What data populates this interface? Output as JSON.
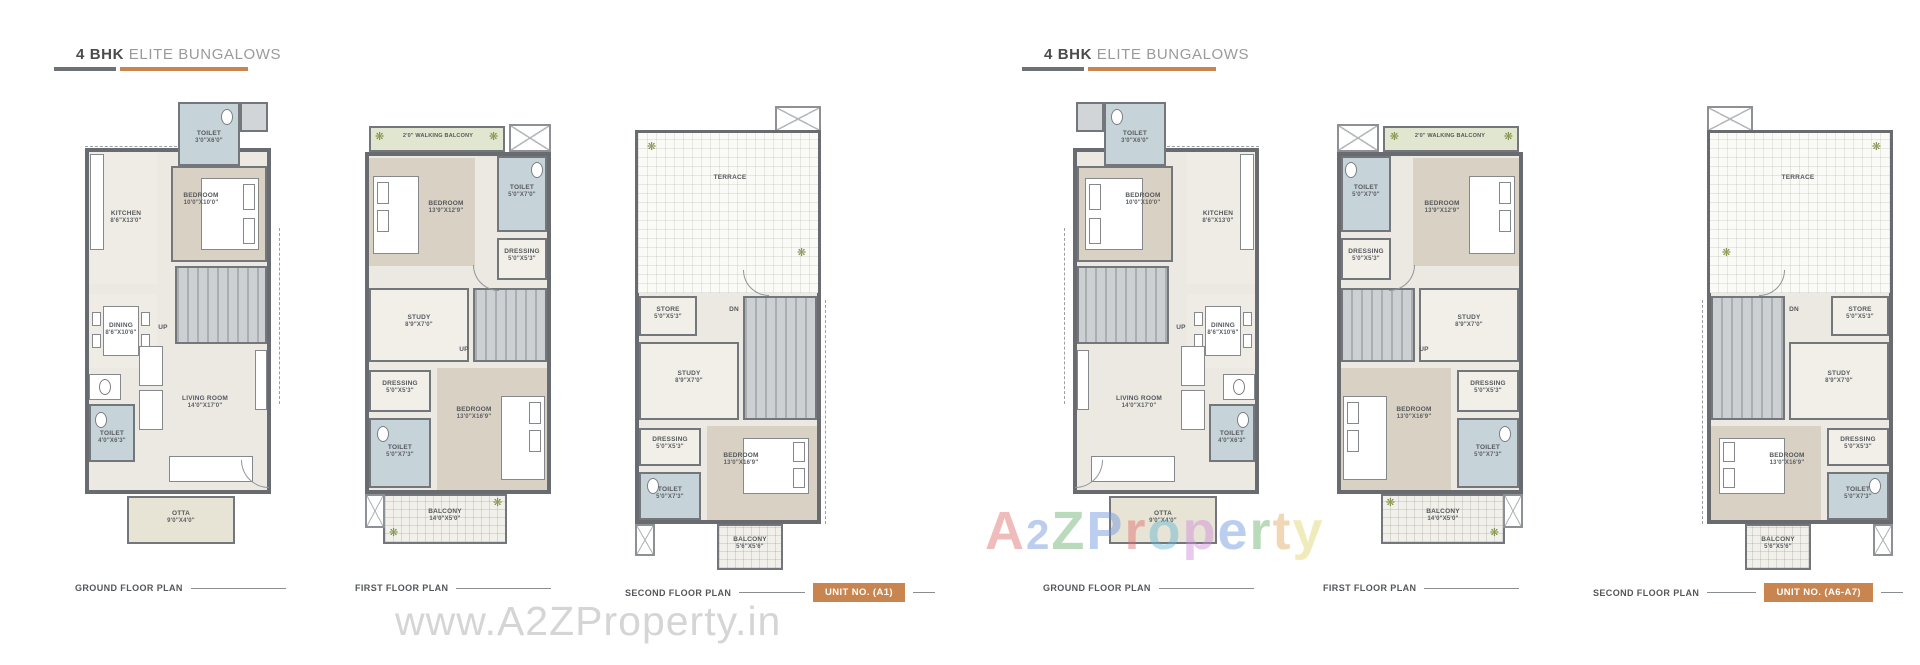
{
  "groups": [
    {
      "title_bold": "4 BHK",
      "title_rest": "ELITE BUNGALOWS",
      "unit_label": "UNIT NO. (A1)"
    },
    {
      "title_bold": "4 BHK",
      "title_rest": "ELITE BUNGALOWS",
      "unit_label": "UNIT NO. (A6-A7)"
    }
  ],
  "plans": [
    {
      "caption": "GROUND FLOOR PLAN",
      "rooms": {
        "toilet_top": {
          "name": "TOILET",
          "dims": "3'0\"X6'0\""
        },
        "kitchen": {
          "name": "KITCHEN",
          "dims": "8'6\"X13'0\""
        },
        "bedroom": {
          "name": "BEDROOM",
          "dims": "10'0\"X10'0\""
        },
        "dining": {
          "name": "DINING",
          "dims": "8'6\"X10'6\""
        },
        "living": {
          "name": "LIVING ROOM",
          "dims": "14'0\"X17'0\""
        },
        "toilet_side": {
          "name": "TOILET",
          "dims": "4'0\"X6'3\""
        },
        "otta": {
          "name": "OTTA",
          "dims": "9'0\"X4'0\""
        },
        "stairs": {
          "name": "UP"
        }
      }
    },
    {
      "caption": "FIRST FLOOR PLAN",
      "rooms": {
        "walking_balcony": {
          "name": "2'0\" WALKING BALCONY"
        },
        "bedroom1": {
          "name": "BEDROOM",
          "dims": "13'9\"X12'9\""
        },
        "toilet1": {
          "name": "TOILET",
          "dims": "5'0\"X7'0\""
        },
        "dressing1": {
          "name": "DRESSING",
          "dims": "5'0\"X5'3\""
        },
        "study": {
          "name": "STUDY",
          "dims": "8'9\"X7'0\""
        },
        "dressing2": {
          "name": "DRESSING",
          "dims": "5'0\"X5'3\""
        },
        "toilet2": {
          "name": "TOILET",
          "dims": "5'0\"X7'3\""
        },
        "bedroom2": {
          "name": "BEDROOM",
          "dims": "13'0\"X16'9\""
        },
        "balcony": {
          "name": "BALCONY",
          "dims": "14'0\"X5'0\""
        },
        "stairs": {
          "name": "UP"
        }
      }
    },
    {
      "caption": "SECOND FLOOR PLAN",
      "rooms": {
        "terrace": {
          "name": "TERRACE"
        },
        "store": {
          "name": "STORE",
          "dims": "5'0\"X5'3\""
        },
        "study": {
          "name": "STUDY",
          "dims": "8'9\"X7'0\""
        },
        "stairs": {
          "name": "DN"
        },
        "dressing": {
          "name": "DRESSING",
          "dims": "5'0\"X5'3\""
        },
        "toilet": {
          "name": "TOILET",
          "dims": "5'0\"X7'3\""
        },
        "bedroom": {
          "name": "BEDROOM",
          "dims": "13'0\"X16'9\""
        },
        "balcony": {
          "name": "BALCONY",
          "dims": "5'6\"X5'6\""
        }
      }
    }
  ],
  "watermarks": {
    "bottom": "www.A2ZProperty.in",
    "brand_letters": [
      {
        "ch": "A",
        "color": "#e06a6a"
      },
      {
        "ch": "2",
        "color": "#6a93e0"
      },
      {
        "ch": "Z",
        "color": "#66b06a"
      },
      {
        "ch": " ",
        "color": "#ffffff"
      },
      {
        "ch": "P",
        "color": "#6a93e0"
      },
      {
        "ch": "r",
        "color": "#e06a6a"
      },
      {
        "ch": "o",
        "color": "#5fb7d4"
      },
      {
        "ch": "p",
        "color": "#cf8ad8"
      },
      {
        "ch": "e",
        "color": "#6a93e0"
      },
      {
        "ch": "r",
        "color": "#66b06a"
      },
      {
        "ch": "t",
        "color": "#e0a75f"
      },
      {
        "ch": "y",
        "color": "#ded568"
      }
    ]
  }
}
